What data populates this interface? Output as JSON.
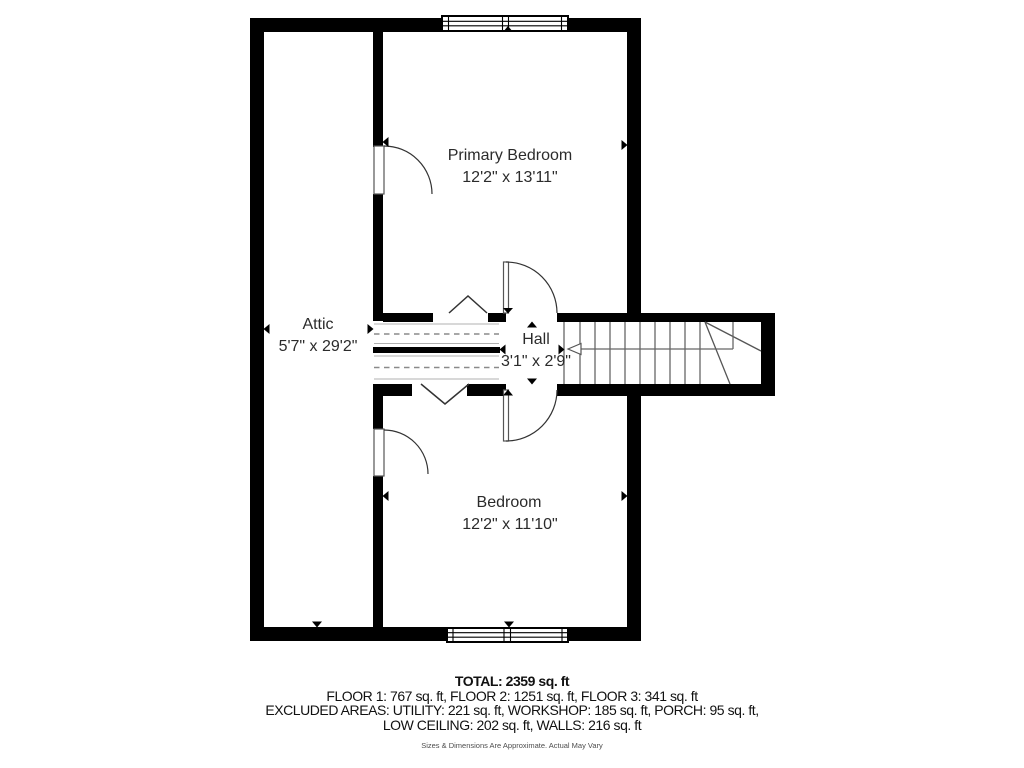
{
  "rooms": {
    "attic": {
      "name": "Attic",
      "dims": "5'7\" x 29'2\""
    },
    "primary_bedroom": {
      "name": "Primary Bedroom",
      "dims": "12'2\" x 13'11\""
    },
    "hall": {
      "name": "Hall",
      "dims": "3'1\" x 2'9\""
    },
    "bedroom": {
      "name": "Bedroom",
      "dims": "12'2\" x 11'10\""
    }
  },
  "footer": {
    "total": "TOTAL: 2359 sq. ft",
    "floors": "FLOOR 1: 767 sq. ft, FLOOR 2: 1251 sq. ft, FLOOR 3: 341 sq. ft",
    "excluded": "EXCLUDED AREAS: UTILITY: 221 sq. ft, WORKSHOP: 185 sq. ft, PORCH: 95 sq. ft,",
    "excluded2": "LOW CEILING: 202 sq. ft, WALLS: 216 sq. ft",
    "disclaimer": "Sizes & Dimensions Are Approximate. Actual May Vary"
  },
  "colors": {
    "wall": "#000000",
    "label_text": "#2b2b2b",
    "stair_line": "#666666",
    "dashed_line": "#8a8a8a"
  }
}
